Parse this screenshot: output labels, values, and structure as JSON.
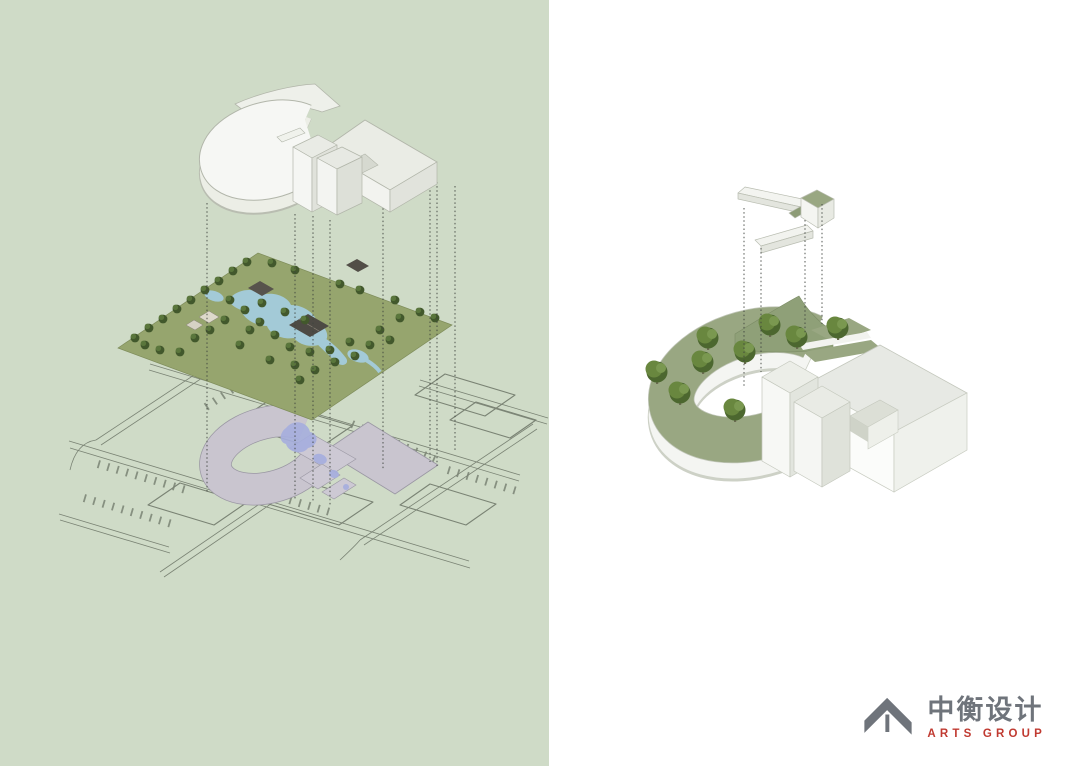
{
  "panels": {
    "left": {
      "background_label": "sage-green-panel",
      "content": "exploded-axonometric-site-diagram"
    },
    "right": {
      "background_label": "white-panel",
      "content": "roof-garden-axonometric-diagram"
    }
  },
  "diagram_layers": {
    "left_top": "building-massing-model",
    "left_middle": "classical-garden-landscape-plane",
    "left_bottom": "site-plan-line-drawing-with-footprint",
    "right_top": "roof-connector-element",
    "right_bottom": "building-with-green-roof-and-trees"
  },
  "logo": {
    "icon": "roof-arrow-icon",
    "company_name": "中衡设计",
    "company_subtitle": "ARTS GROUP"
  },
  "colors": {
    "left_background": "#cfdbc7",
    "garden_green": "#96a56e",
    "garden_tree_green": "#42582c",
    "garden_water": "#a3cad7",
    "plan_line": "#7a8374",
    "footprint_gray": "#c9c5cf",
    "plan_water": "#a6aede",
    "dashed_line": "#3f443e",
    "roof_green": "#99a782",
    "roof_tree_green": "#69873f",
    "building_white": "#f6f7f4",
    "building_shade": "#e4e6df",
    "logo_gray": "#6f747b",
    "logo_red": "#c03a31"
  }
}
